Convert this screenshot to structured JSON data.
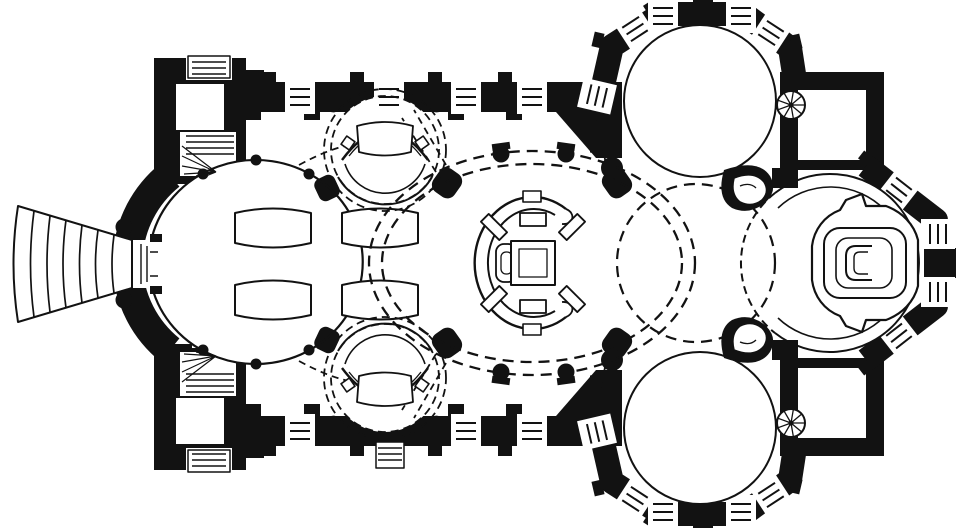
{
  "plan": {
    "type": "church-floor-plan",
    "rendering": "black-ink-poche-on-white",
    "orientation": "entrance-at-left-west, high-altar-at-right-east",
    "palette": {
      "ink": "#121212",
      "paper": "#ffffff"
    },
    "spaces": [
      {
        "name": "entrance-stair-fan",
        "desc": "fan of curved exterior steps at west portal"
      },
      {
        "name": "west-oval-nave",
        "furniture": "four curved pew blocks in two rows"
      },
      {
        "name": "north-side-chapel",
        "furniture": "chapel altar with canopy arc"
      },
      {
        "name": "south-side-chapel",
        "furniture": "chapel altar with canopy arc"
      },
      {
        "name": "central-oval-bay",
        "furniture": "central shrine altar with C-shaped screen and baldachin, four free-standing columns"
      },
      {
        "name": "north-transept-rotunda",
        "desc": "large circular bay in octagonal shell with windows"
      },
      {
        "name": "south-transept-rotunda",
        "desc": "large circular bay in octagonal shell with windows"
      },
      {
        "name": "crossing",
        "desc": "dashed vault circle between rotundas"
      },
      {
        "name": "choir-rotunda",
        "furniture": "stepped high-altar platform with C-shaped mensa"
      },
      {
        "name": "northwest-tower",
        "features": [
          "entry-steps",
          "winder-stair"
        ]
      },
      {
        "name": "southwest-tower",
        "features": [
          "entry-steps",
          "winder-stair"
        ]
      },
      {
        "name": "north-sacristy",
        "features": [
          "spiral-stair"
        ]
      },
      {
        "name": "south-sacristy",
        "features": [
          "spiral-stair"
        ]
      },
      {
        "name": "north-pulpit-scroll",
        "desc": "scrolled wall junction between crossing and choir"
      },
      {
        "name": "south-pulpit-scroll",
        "desc": "scrolled wall junction between crossing and choir"
      }
    ],
    "conventions": {
      "walls": "solid black poche with pilaster bumps",
      "vault_projections": "dashed lines",
      "windows": "white wall gaps with parallel mullion lines",
      "stairs": "parallel tread lines and radiating winders"
    }
  }
}
